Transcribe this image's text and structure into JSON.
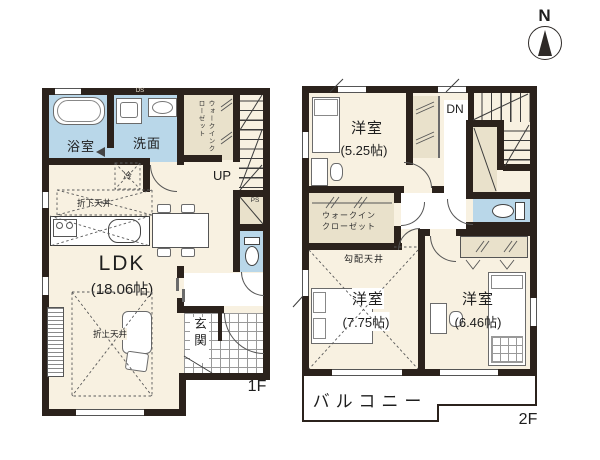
{
  "compass": {
    "north_label": "N"
  },
  "floor1": {
    "floor_label": "1F",
    "bathroom_label": "浴室",
    "washroom_label": "洗面",
    "ds_label": "DS",
    "wic_line1": "ウォークイン",
    "wic_line2": "クローゼット",
    "stairs_label": "UP",
    "ps_label": "PS",
    "fridge_label": "冷",
    "lowered_ceiling_label": "折下天井",
    "raised_ceiling_label": "折上天井",
    "ldk_label": "LDK",
    "ldk_area": "(18.06帖)",
    "genkan_label": "玄関"
  },
  "floor2": {
    "floor_label": "2F",
    "stairs_label": "DN",
    "bedroom1_label": "洋室",
    "bedroom1_area": "(5.25帖)",
    "wic_line1": "ウォークイン",
    "wic_line2": "クローゼット",
    "sloped_ceiling_label": "勾配天井",
    "bedroom2_label": "洋室",
    "bedroom2_area": "(7.75帖)",
    "bedroom3_label": "洋室",
    "bedroom3_area": "(6.46帖)",
    "balcony_label": "バルコニー"
  },
  "colors": {
    "wall": "#2b221c",
    "room_floor": "#f8f1e1",
    "wet_area": "#b9d7e9",
    "closet": "#e9e1cb",
    "background": "#ffffff"
  }
}
